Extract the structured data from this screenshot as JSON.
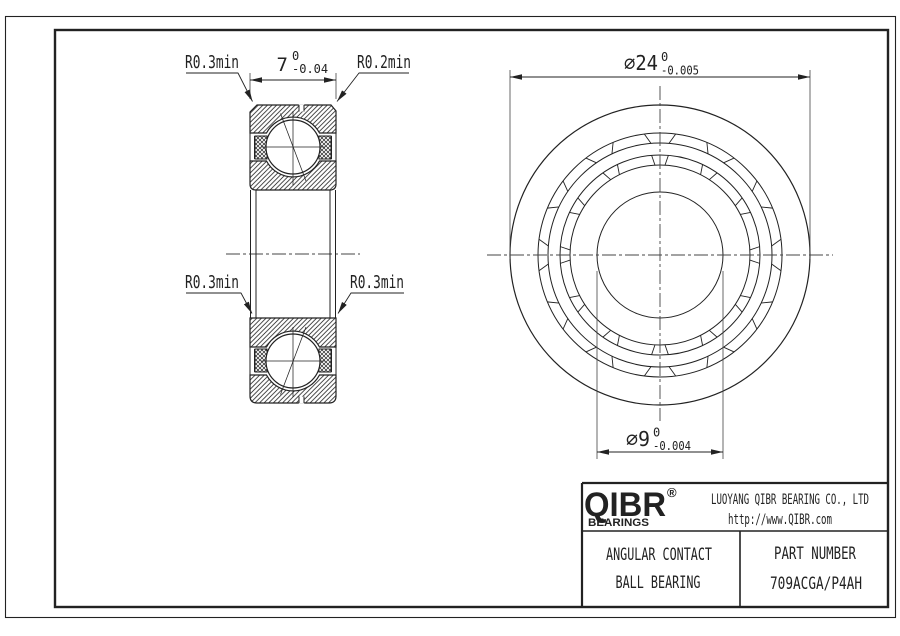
{
  "drawing": {
    "section_view": {
      "leader_top_left": "R0.3min",
      "leader_top_right": "R0.2min",
      "leader_bottom_left": "R0.3min",
      "leader_bottom_right": "R0.3min",
      "dim_width": {
        "value": "7",
        "tol_upper": "0",
        "tol_lower": "-0.04"
      }
    },
    "front_view": {
      "dim_outer": {
        "label": "⌀24",
        "tol_upper": "0",
        "tol_lower": "-0.005"
      },
      "dim_bore": {
        "label": "⌀9",
        "tol_upper": "0",
        "tol_lower": "-0.004"
      }
    }
  },
  "title_block": {
    "logo_text": "QIBR",
    "logo_registered": "®",
    "logo_subtext": "BEARINGS",
    "company_name": "LUOYANG QIBR BEARING CO., LTD",
    "website": "http://www.QIBR.com",
    "product_type_line1": "ANGULAR CONTACT",
    "product_type_line2": "BALL BEARING",
    "part_number_label": "PART NUMBER",
    "part_number": "709ACGA/P4AH"
  },
  "colors": {
    "line": "#222222",
    "background": "#ffffff"
  }
}
